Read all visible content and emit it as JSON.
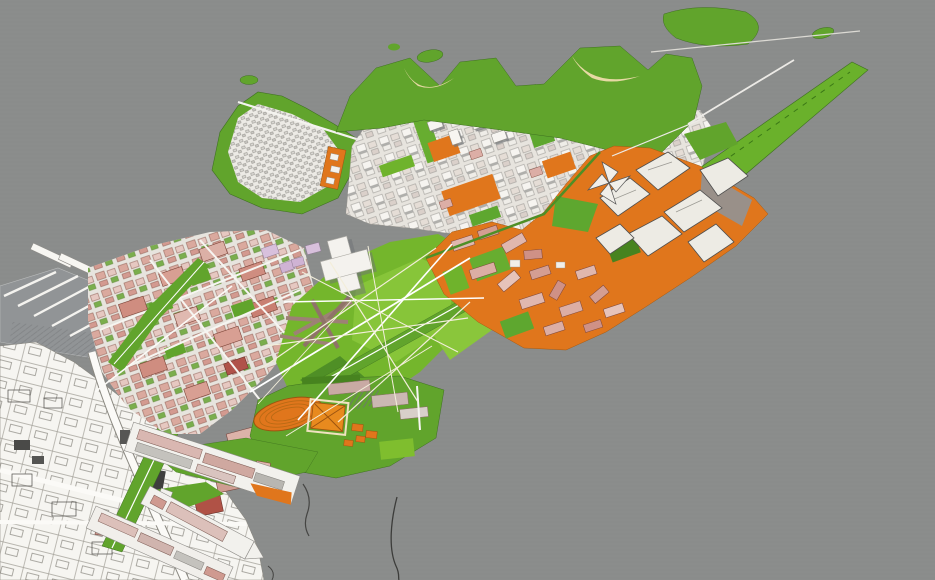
{
  "canvas": {
    "width": 935,
    "height": 580
  },
  "visible_text": [],
  "palette": {
    "water": "#8b8d8c",
    "water_line": "#7f8282",
    "park_green": "#61a42c",
    "bright_green": "#7fbe2e",
    "pale_green": "#8ac63b",
    "dark_green": "#47831f",
    "orange": "#e0761c",
    "orange_dark": "#b96a14",
    "sand": "#e7d9a4",
    "city_white": "#f6f5f1",
    "ground_light": "#e7e4de",
    "plate_gray": "#919496",
    "building_white": "#f2f1ed",
    "building_gray": "#c4c2bd",
    "shadow_gray": "#6e7173",
    "pink": "#e0b7ae",
    "rose": "#cf9186",
    "salmon": "#d89f93",
    "red": "#b0524a",
    "lilac": "#d8c0dc",
    "mauve": "#c9aaa4",
    "cream_path": "#f3eedb",
    "line_dark": "#3c3c3a",
    "white": "#ffffff"
  },
  "regions": [
    {
      "name": "open-water",
      "fill": "water"
    },
    {
      "name": "existing-city-linework",
      "fill": "city_white"
    },
    {
      "name": "marina-wharf",
      "fill": "plate_gray"
    },
    {
      "name": "residential-grid-district",
      "fill": "salmon"
    },
    {
      "name": "old-town-peninsula",
      "fill": "park_green"
    },
    {
      "name": "north-harbor-district",
      "fill": "ground_light"
    },
    {
      "name": "green-headland",
      "fill": "park_green"
    },
    {
      "name": "beach-coves",
      "fill": "sand"
    },
    {
      "name": "green-islets",
      "fill": "park_green"
    },
    {
      "name": "green-pier-promenade",
      "fill": "park_green"
    },
    {
      "name": "central-park",
      "fill": "pale_green"
    },
    {
      "name": "diagonal-boulevard",
      "fill": "park_green"
    },
    {
      "name": "orange-waterfront-district",
      "fill": "orange"
    },
    {
      "name": "faceted-pavilion-quarter",
      "fill": "building_white"
    },
    {
      "name": "sports-platform",
      "fill": "park_green"
    },
    {
      "name": "running-track",
      "fill": "orange"
    },
    {
      "name": "warehouse-piers",
      "fill": "building_white"
    },
    {
      "name": "breakwaters",
      "fill": "line_dark"
    },
    {
      "name": "linear-park-seam",
      "fill": "park_green"
    }
  ]
}
